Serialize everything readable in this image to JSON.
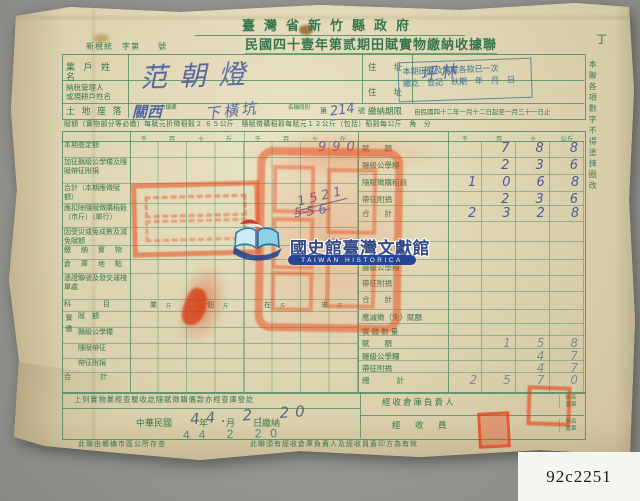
{
  "photo": {
    "catalog_label": "92c2251"
  },
  "watermark": {
    "org_zh": "國史館臺灣文獻館",
    "org_en": "TAIWAN HISTORICA"
  },
  "header": {
    "agency": "臺灣省新竹縣政府",
    "serial": "新梘統　字第　　號",
    "title": "民國四十壹年第贰期田賦實物繳納收據聯",
    "copy_mark": "丁"
  },
  "info": {
    "owner_label": "業 戶 姓 名",
    "owner_value": "范朝燈",
    "addr_label_1": "住　　址",
    "addr_value_1": "坪林",
    "manager_label_line1": "納稅管理人",
    "manager_label_line2": "或現耕戶姓名",
    "addr_label_2": "住　　址",
    "land_label": "土 地 座 落",
    "land_township_value": "關西",
    "land_township_suffix": "市鎮鄉",
    "land_section_value": "下橫坑",
    "land_section_suffix": "名稱段別",
    "land_no_prefix": "第",
    "land_no_value": "214",
    "land_no_suffix": "號",
    "deadline_label": "繳納期限",
    "deadline_value": "自民國四十二年一月十二日起至一月三十一日止",
    "stamp_line1": "本期田賦及隨賦各款已一次",
    "stamp_line2": "繳訖　登記　秋期　年　月　日",
    "rate_note": "賦額（實物部分等必繳）每賦元折徵稻穀２.６５公斤　隨賦徵購稻穀每賦元１２公斤（包括）稻穀每公斤　角　分"
  },
  "side_note": "本聯各項數字不得塗抹圈改",
  "table": {
    "left_headers": [
      "千",
      "百",
      "十",
      "斤",
      "千",
      "百",
      "十",
      "斤"
    ],
    "col_headers": [
      "千",
      "百",
      "十",
      "公斤"
    ],
    "left_rows": [
      "本期查定額",
      "加征縣級公學糧及隨賦帶征附捐",
      "合計（本期應徵賦額）",
      "應扣除隨賦徵購稻穀（市斤）（單行）",
      "因受災或免成數及減免賦額",
      "繳 納 實 物",
      "倉 庫 地 點",
      "憑證聯號及發交運棧單處",
      "科　　目",
      "賦　額",
      "縣級公學糧",
      "隨賦帶征",
      "帶征附捐",
      "合　　計"
    ],
    "paid_group_label": "實繳",
    "subject_cols": [
      "業",
      "佃",
      "在",
      "來"
    ],
    "subject_unit": "斤",
    "right_rows": [
      {
        "label": "賦　　額",
        "value": "788"
      },
      {
        "label": "縣級公學糧",
        "value": "236"
      },
      {
        "label": "隨賦徵購稻穀",
        "value": "1068"
      },
      {
        "label": "帶征附捐",
        "value": "236"
      },
      {
        "label": "合　　計",
        "value": "2328"
      },
      {
        "label": "",
        "value": ""
      },
      {
        "label": "賦　　額",
        "value": ""
      },
      {
        "label": "縣級公學糧",
        "value": ""
      },
      {
        "label": "帶征附捐",
        "value": ""
      },
      {
        "label": "合　　計",
        "value": ""
      },
      {
        "label": "應減徵（免）賦額",
        "value": ""
      },
      {
        "label": "實 繳 數 量",
        "value": ""
      },
      {
        "label": "賦　　額",
        "value": "158"
      },
      {
        "label": "縣級公學糧",
        "value": "47"
      },
      {
        "label": "帶征附捐",
        "value": "47"
      },
      {
        "label": "總　　計",
        "value": "2570"
      }
    ],
    "written_990": "990",
    "written_1521": "1521",
    "written_556": "556"
  },
  "footer": {
    "verified_note": "上列實物業經查驗收訖隨賦徵購價款亦經查庫發訖",
    "date_printed": "中華民國　　　年　　月　　日繳納",
    "date_hand": "44. 2. 20",
    "date_stamp": "44 2 20",
    "warehouse_head_label": "經收倉庫負責人",
    "clerk_label": "經　收　員",
    "sign_label_1": "簽名",
    "sign_label_2": "蓋章",
    "note_left": "此聯由鄉鎮市區公所存查",
    "note_right": "此聯須有經收倉庫負責人及經收員蓋印方為有效"
  }
}
